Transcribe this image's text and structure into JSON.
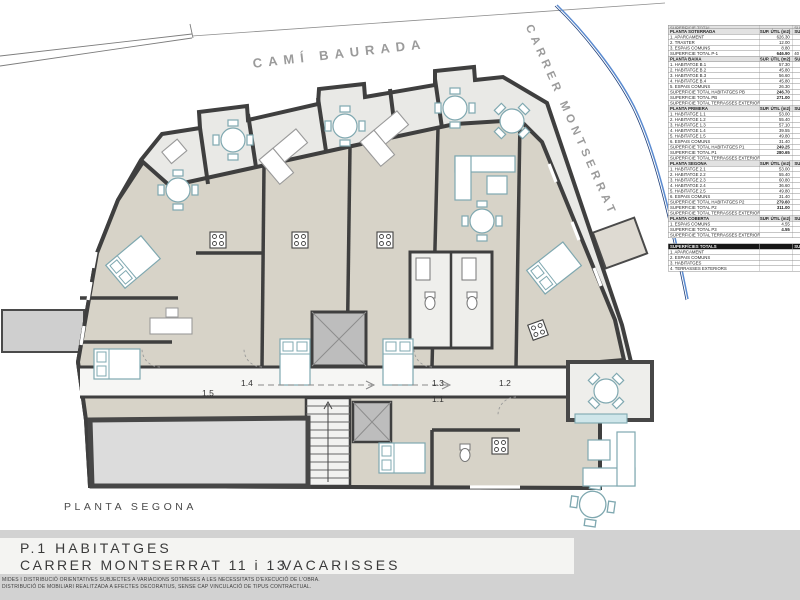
{
  "plan": {
    "label": "PLANTA SEGONA"
  },
  "streets": {
    "top": "CAMÍ BAURADA",
    "right": "CARRER MONTSERRAT"
  },
  "doors": {
    "d15": "1.5",
    "d14": "1.4",
    "d13": "1.3",
    "d12": "1.2",
    "d11": "1.1"
  },
  "north": {
    "label": "N"
  },
  "scale": {
    "l0": "0",
    "l1": "1m",
    "l2": "2m",
    "l3": "3m"
  },
  "title": {
    "project": "P.1   HABITATGES",
    "address": "CARRER  MONTSERRAT 11 i 13",
    "town": "VACARISSES"
  },
  "disclaimer": {
    "line1": "MIDES I DISTRIBUCIÓ ORIENTATIVES SUBJECTES A VARIACIONS SOTMESES A LES NECESSITATS D'EXECUCIÓ DE L'OBRA.",
    "line2": "DISTRIBUCIÓ DE MOBILIARI REALITZADA A EFECTES DECORATIUS, SENSE CAP VINCULACIÓ DE TIPUS CONTRACTUAL."
  },
  "colors": {
    "wall": "#3f3f3f",
    "room": "#d7d3c8",
    "terrace": "#e9e9e6",
    "furniture_accent": "#7fa8b0",
    "street_line": "#5b8bd0",
    "street_text": "#9b9b9b",
    "band": "#d2d2d2"
  },
  "area_table": {
    "sections": [
      {
        "cut": true,
        "title": "SUPERFICIE TOTAL",
        "col1": "",
        "col2": "SUP. CONSTRUÏDA"
      },
      {
        "title": "PLANTA SOTERRADA",
        "col1": "SUP. ÚTIL (m2)",
        "col2": "SUP. CONSTRUÏDA (m2)",
        "rows": [
          {
            "label": "1. APARCAMENT",
            "value": "626.30"
          },
          {
            "label": "2. TRASTER",
            "value": "12.00"
          },
          {
            "label": "3. ESPAIS COMUNS",
            "value": "8.80"
          },
          {
            "t": "total",
            "label": "SUPERFICIE TOTAL  P-1",
            "value": "646.90",
            "value2": "40"
          }
        ]
      },
      {
        "title": "PLANTA BAIXA",
        "col1": "SUP. ÚTIL (m2)",
        "col2": "SUP. CONSTRUÏDA (m2)",
        "rows": [
          {
            "label": "1. HABITATGE B.1",
            "value": "57.30"
          },
          {
            "label": "2. HABITATGE B.2",
            "value": "45.80"
          },
          {
            "label": "3. HABITATGE B.3",
            "value": "56.60"
          },
          {
            "label": "4. HABITATGE B.4",
            "value": "45.80"
          },
          {
            "label": "5. ESPAIS COMUNS",
            "value": "26.30"
          },
          {
            "t": "total",
            "label": "SUPERFICIE TOTAL HABITATGES PB",
            "value": "246.70"
          },
          {
            "t": "total",
            "label": "SUPERFICIE TOTAL PB",
            "value": "271.00"
          },
          {
            "t": "note",
            "label": "SUPERFICIE TOTAL TERRASSES EXTERIORS PB",
            "value": ""
          }
        ]
      },
      {
        "title": "PLANTA PRIMERA",
        "col1": "SUP. ÚTIL (m2)",
        "col2": "SUP. CONSTRUÏDA (m2)",
        "rows": [
          {
            "label": "1. HABITATGE 1.1",
            "value": "53.00"
          },
          {
            "label": "2. HABITATGE 1.2",
            "value": "55.40"
          },
          {
            "label": "3. HABITATGE 1.3",
            "value": "57.10"
          },
          {
            "label": "4. HABITATGE 1.4",
            "value": "39.55"
          },
          {
            "label": "5. HABITATGE 1.5",
            "value": "49.80"
          },
          {
            "label": "6. ESPAIS COMUNS",
            "value": "31.40"
          },
          {
            "t": "total",
            "label": "SUPERFICIE TOTAL HABITATGES P1",
            "value": "249.25"
          },
          {
            "t": "total",
            "label": "SUPERFICIE TOTAL P1",
            "value": "280.65"
          },
          {
            "t": "note",
            "label": "SUPERFICIE TOTAL TERRASSES EXTERIORS P1",
            "value": ""
          }
        ]
      },
      {
        "title": "PLANTA SEGONA",
        "col1": "SUP. ÚTIL (m2)",
        "col2": "SUP. CONSTRUÏDA (m2)",
        "rows": [
          {
            "label": "1. HABITATGE 2.1",
            "value": "53.00"
          },
          {
            "label": "2. HABITATGE 2.2",
            "value": "55.40"
          },
          {
            "label": "3. HABITATGE 2.3",
            "value": "60.80"
          },
          {
            "label": "4. HABITATGE 2.4",
            "value": "36.60"
          },
          {
            "label": "5. HABITATGE 2.5",
            "value": "49.80"
          },
          {
            "label": "6. ESPAIS COMUNS",
            "value": "31.40"
          },
          {
            "t": "total",
            "label": "SUPERFICIE TOTAL HABITATGES P2",
            "value": "279.60"
          },
          {
            "t": "total",
            "label": "SUPERFICIE TOTAL P2",
            "value": "311.00"
          },
          {
            "t": "note",
            "label": "SUPERFICIE TOTAL TERRASSES EXTERIORS P2",
            "value": ""
          }
        ]
      },
      {
        "title": "PLANTA COBERTA",
        "col1": "SUP. ÚTIL (m2)",
        "col2": "SUP. CONSTRUÏDA (m2)",
        "rows": [
          {
            "label": "1. ESPAIS COMUNS",
            "value": "4.55"
          },
          {
            "t": "total",
            "label": "SUPERFICIE TOTAL P3",
            "value": "4.55"
          },
          {
            "t": "note",
            "label": "SUPERFICIE TOTAL TERRASSES EXTERIORS P3",
            "value": ""
          }
        ]
      },
      {
        "gap": true,
        "dark": true,
        "title": "SUPERFÍCIES TOTALS",
        "col1": "",
        "col2": "SUP. CONSTRUÏDA (m2)",
        "rows": [
          {
            "label": "1. APARCAMENT",
            "value": ""
          },
          {
            "label": "2. ESPAIS COMUNS",
            "value": ""
          },
          {
            "label": "3. HABITATGES",
            "value": ""
          },
          {
            "label": "4. TERRASSES EXTERIORS",
            "value": ""
          }
        ]
      }
    ]
  }
}
